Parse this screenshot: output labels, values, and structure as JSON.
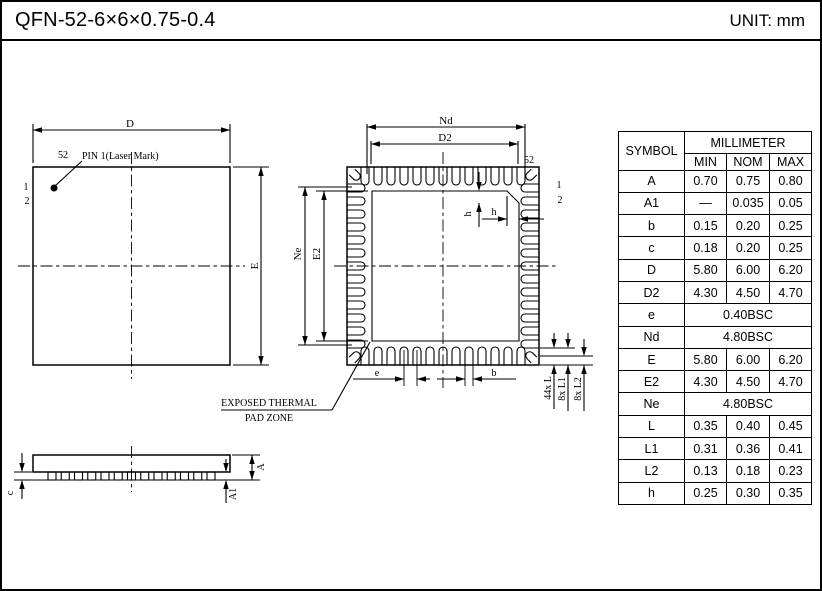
{
  "page": {
    "title": "QFN-52-6×6×0.75-0.4",
    "unit_label": "UNIT: mm"
  },
  "top_view": {
    "dim_width": "D",
    "dim_height": "E",
    "pin_52": "52",
    "pin_1_note": "PIN 1(Laser Mark)",
    "pin_1": "1",
    "pin_2": "2"
  },
  "bottom_view": {
    "dim_pin_span_x": "Nd",
    "dim_pad_width": "D2",
    "dim_pin_span_y": "Ne",
    "dim_pad_height": "E2",
    "pin_52": "52",
    "pin_1": "1",
    "pin_2": "2",
    "dim_chamfer_v": "h",
    "dim_chamfer_h": "h",
    "dim_pitch": "e",
    "dim_lead_width": "b",
    "dim_lead_length": "44x L",
    "dim_lead_length_1": "8x L1",
    "dim_lead_length_2": "8x L2",
    "thermal_note_line1": "EXPOSED THERMAL",
    "thermal_note_line2": "PAD ZONE"
  },
  "side_view": {
    "dim_lead_thickness": "c",
    "dim_height": "A",
    "dim_standoff": "A1"
  },
  "table": {
    "symbol_header": "SYMBOL",
    "unit_header": "MILLIMETER",
    "col_headers": [
      "MIN",
      "NOM",
      "MAX"
    ],
    "rows": [
      {
        "symbol": "A",
        "min": "0.70",
        "nom": "0.75",
        "max": "0.80"
      },
      {
        "symbol": "A1",
        "min": "—",
        "nom": "0.035",
        "max": "0.05"
      },
      {
        "symbol": "b",
        "min": "0.15",
        "nom": "0.20",
        "max": "0.25"
      },
      {
        "symbol": "c",
        "min": "0.18",
        "nom": "0.20",
        "max": "0.25"
      },
      {
        "symbol": "D",
        "min": "5.80",
        "nom": "6.00",
        "max": "6.20"
      },
      {
        "symbol": "D2",
        "min": "4.30",
        "nom": "4.50",
        "max": "4.70"
      },
      {
        "symbol": "e",
        "span": "0.40BSC"
      },
      {
        "symbol": "Nd",
        "span": "4.80BSC"
      },
      {
        "symbol": "E",
        "min": "5.80",
        "nom": "6.00",
        "max": "6.20"
      },
      {
        "symbol": "E2",
        "min": "4.30",
        "nom": "4.50",
        "max": "4.70"
      },
      {
        "symbol": "Ne",
        "span": "4.80BSC"
      },
      {
        "symbol": "L",
        "min": "0.35",
        "nom": "0.40",
        "max": "0.45"
      },
      {
        "symbol": "L1",
        "min": "0.31",
        "nom": "0.36",
        "max": "0.41"
      },
      {
        "symbol": "L2",
        "min": "0.13",
        "nom": "0.18",
        "max": "0.23"
      },
      {
        "symbol": "h",
        "min": "0.25",
        "nom": "0.30",
        "max": "0.35"
      }
    ]
  }
}
